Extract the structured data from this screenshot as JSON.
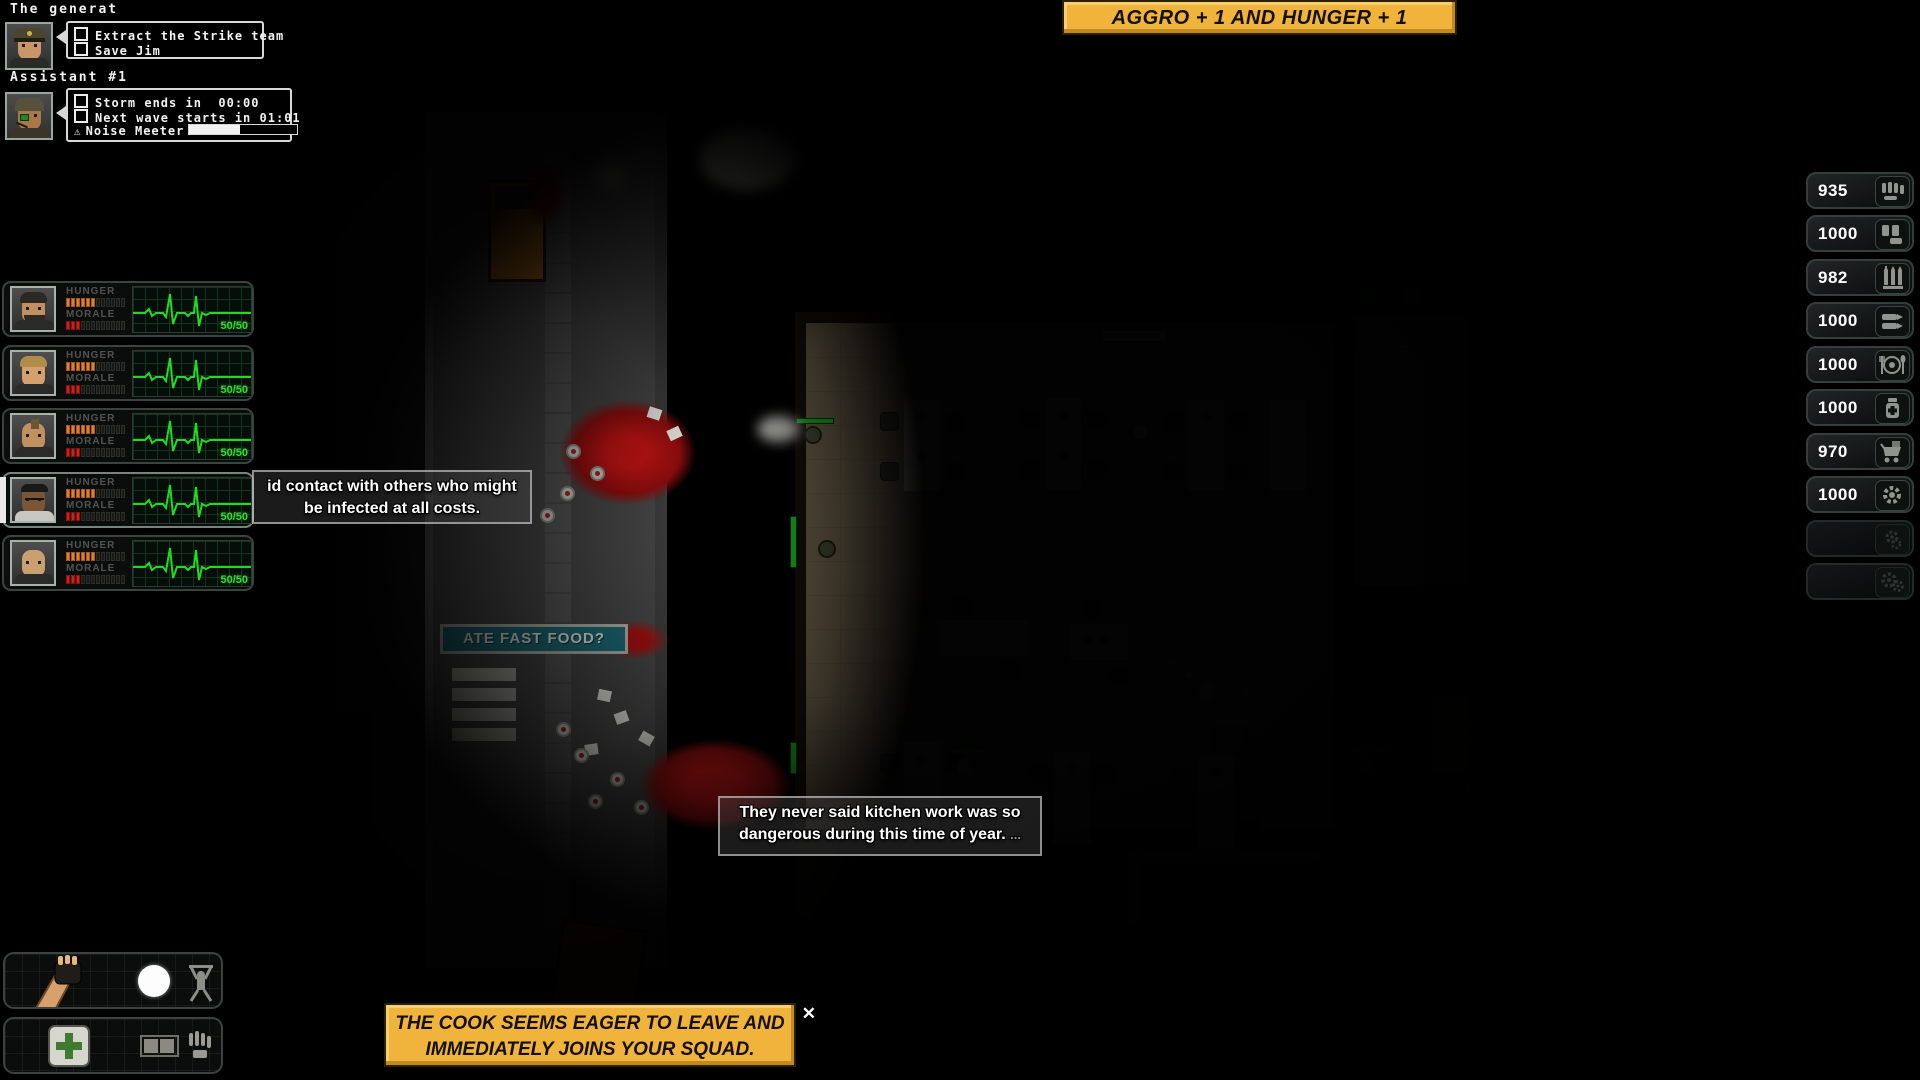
{
  "hud": {
    "general": {
      "name": "The generat",
      "tasks": [
        "Extract the Strike team",
        "Save Jim"
      ]
    },
    "assistant": {
      "name": "Assistant #1",
      "timers": [
        {
          "label": "Storm ends in",
          "time": "00:00"
        },
        {
          "label": "Next wave starts in",
          "time": "01:01"
        }
      ],
      "noise_label": "Noise Meeter",
      "noise_percent": 47
    },
    "top_banner": "AGGRO + 1 AND HUNGER + 1",
    "bottom_banner": {
      "line1": "THE COOK SEEMS EAGER TO LEAVE AND",
      "line2": "IMMEDIATELY JOINS YOUR SQUAD.",
      "close": "✕"
    }
  },
  "squad": {
    "hunger_label": "HUNGER",
    "morale_label": "MORALE",
    "members": [
      {
        "hunger": 6,
        "hunger_max": 12,
        "morale": 3,
        "morale_max": 12,
        "hp": "50/50",
        "selected": false
      },
      {
        "hunger": 6,
        "hunger_max": 12,
        "morale": 3,
        "morale_max": 12,
        "hp": "50/50",
        "selected": false
      },
      {
        "hunger": 6,
        "hunger_max": 12,
        "morale": 3,
        "morale_max": 12,
        "hp": "50/50",
        "selected": false
      },
      {
        "hunger": 6,
        "hunger_max": 12,
        "morale": 3,
        "morale_max": 12,
        "hp": "50/50",
        "selected": true
      },
      {
        "hunger": 6,
        "hunger_max": 12,
        "morale": 3,
        "morale_max": 12,
        "hp": "50/50",
        "selected": false
      }
    ]
  },
  "speech": [
    {
      "line1": "id contact with others who might",
      "line2": "be infected at all costs."
    },
    {
      "line1": "They never said kitchen work was so",
      "line2": "dangerous during this time of year.",
      "more": "..."
    }
  ],
  "resources": [
    {
      "value": "935",
      "icon": "pistol-ammo"
    },
    {
      "value": "1000",
      "icon": "shotgun-shells"
    },
    {
      "value": "982",
      "icon": "rifle-ammo"
    },
    {
      "value": "1000",
      "icon": "heavy-ammo"
    },
    {
      "value": "1000",
      "icon": "food"
    },
    {
      "value": "1000",
      "icon": "meds"
    },
    {
      "value": "970",
      "icon": "cart"
    },
    {
      "value": "1000",
      "icon": "gear"
    },
    {
      "value": "",
      "icon": "tools-dim"
    },
    {
      "value": "",
      "icon": "gears-dim"
    }
  ],
  "map": {
    "signs": {
      "fastfood": "ATE FAST FOOD?",
      "power_line1": "ALTERNATIVE",
      "power_line2": "POWER",
      "power_line3": "HIGH VOLTAGE"
    }
  },
  "colors": {
    "banner_yellow": "#f0b43c",
    "ekg_green": "#1edd1e",
    "hunger_orange": "#e07f2c",
    "morale_red": "#d41d1d",
    "hp_green": "#3ed63e"
  }
}
